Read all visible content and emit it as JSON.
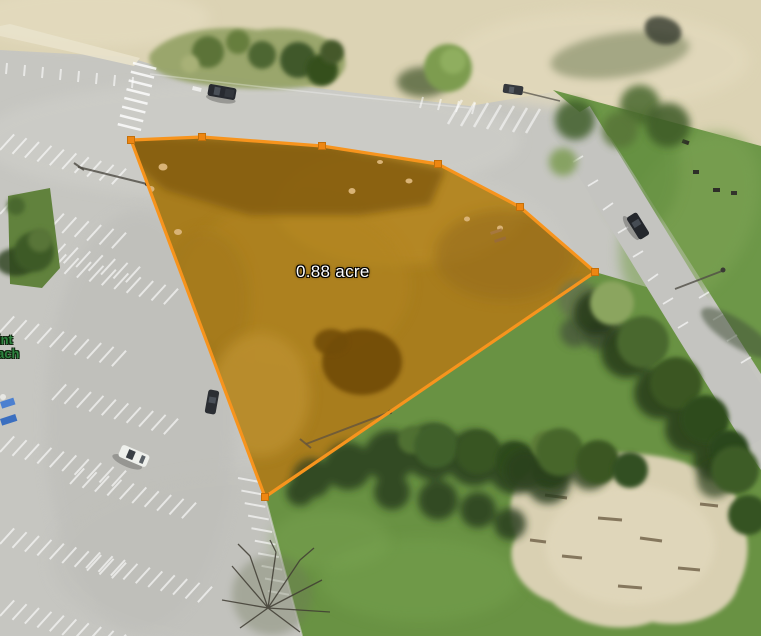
{
  "map": {
    "measurement": {
      "area_label": "0.88 acre",
      "vertices": [
        [
          131,
          140
        ],
        [
          202,
          137
        ],
        [
          322,
          146
        ],
        [
          438,
          164
        ],
        [
          520,
          207
        ],
        [
          595,
          272
        ],
        [
          265,
          497
        ]
      ],
      "stroke_color": "#f7941d",
      "fill_color": "rgba(247,148,29,0.13)",
      "vertex_color": "#ee8611",
      "vertex_stroke": "#c4700a"
    },
    "labels": {
      "place_fragment_line1": "int",
      "place_fragment_line2": "ach",
      "place_color": "#2e8540"
    },
    "palette": {
      "measurement_orange": "#f7941d",
      "measured_fill_tint": "#8d761d",
      "pavement_gray": "#c6c6c1",
      "sand_beige": "#dcd3b4",
      "grass_green": "#6d9748",
      "tree_dark_green": "#3a5724",
      "label_text": "#ffffff"
    }
  }
}
